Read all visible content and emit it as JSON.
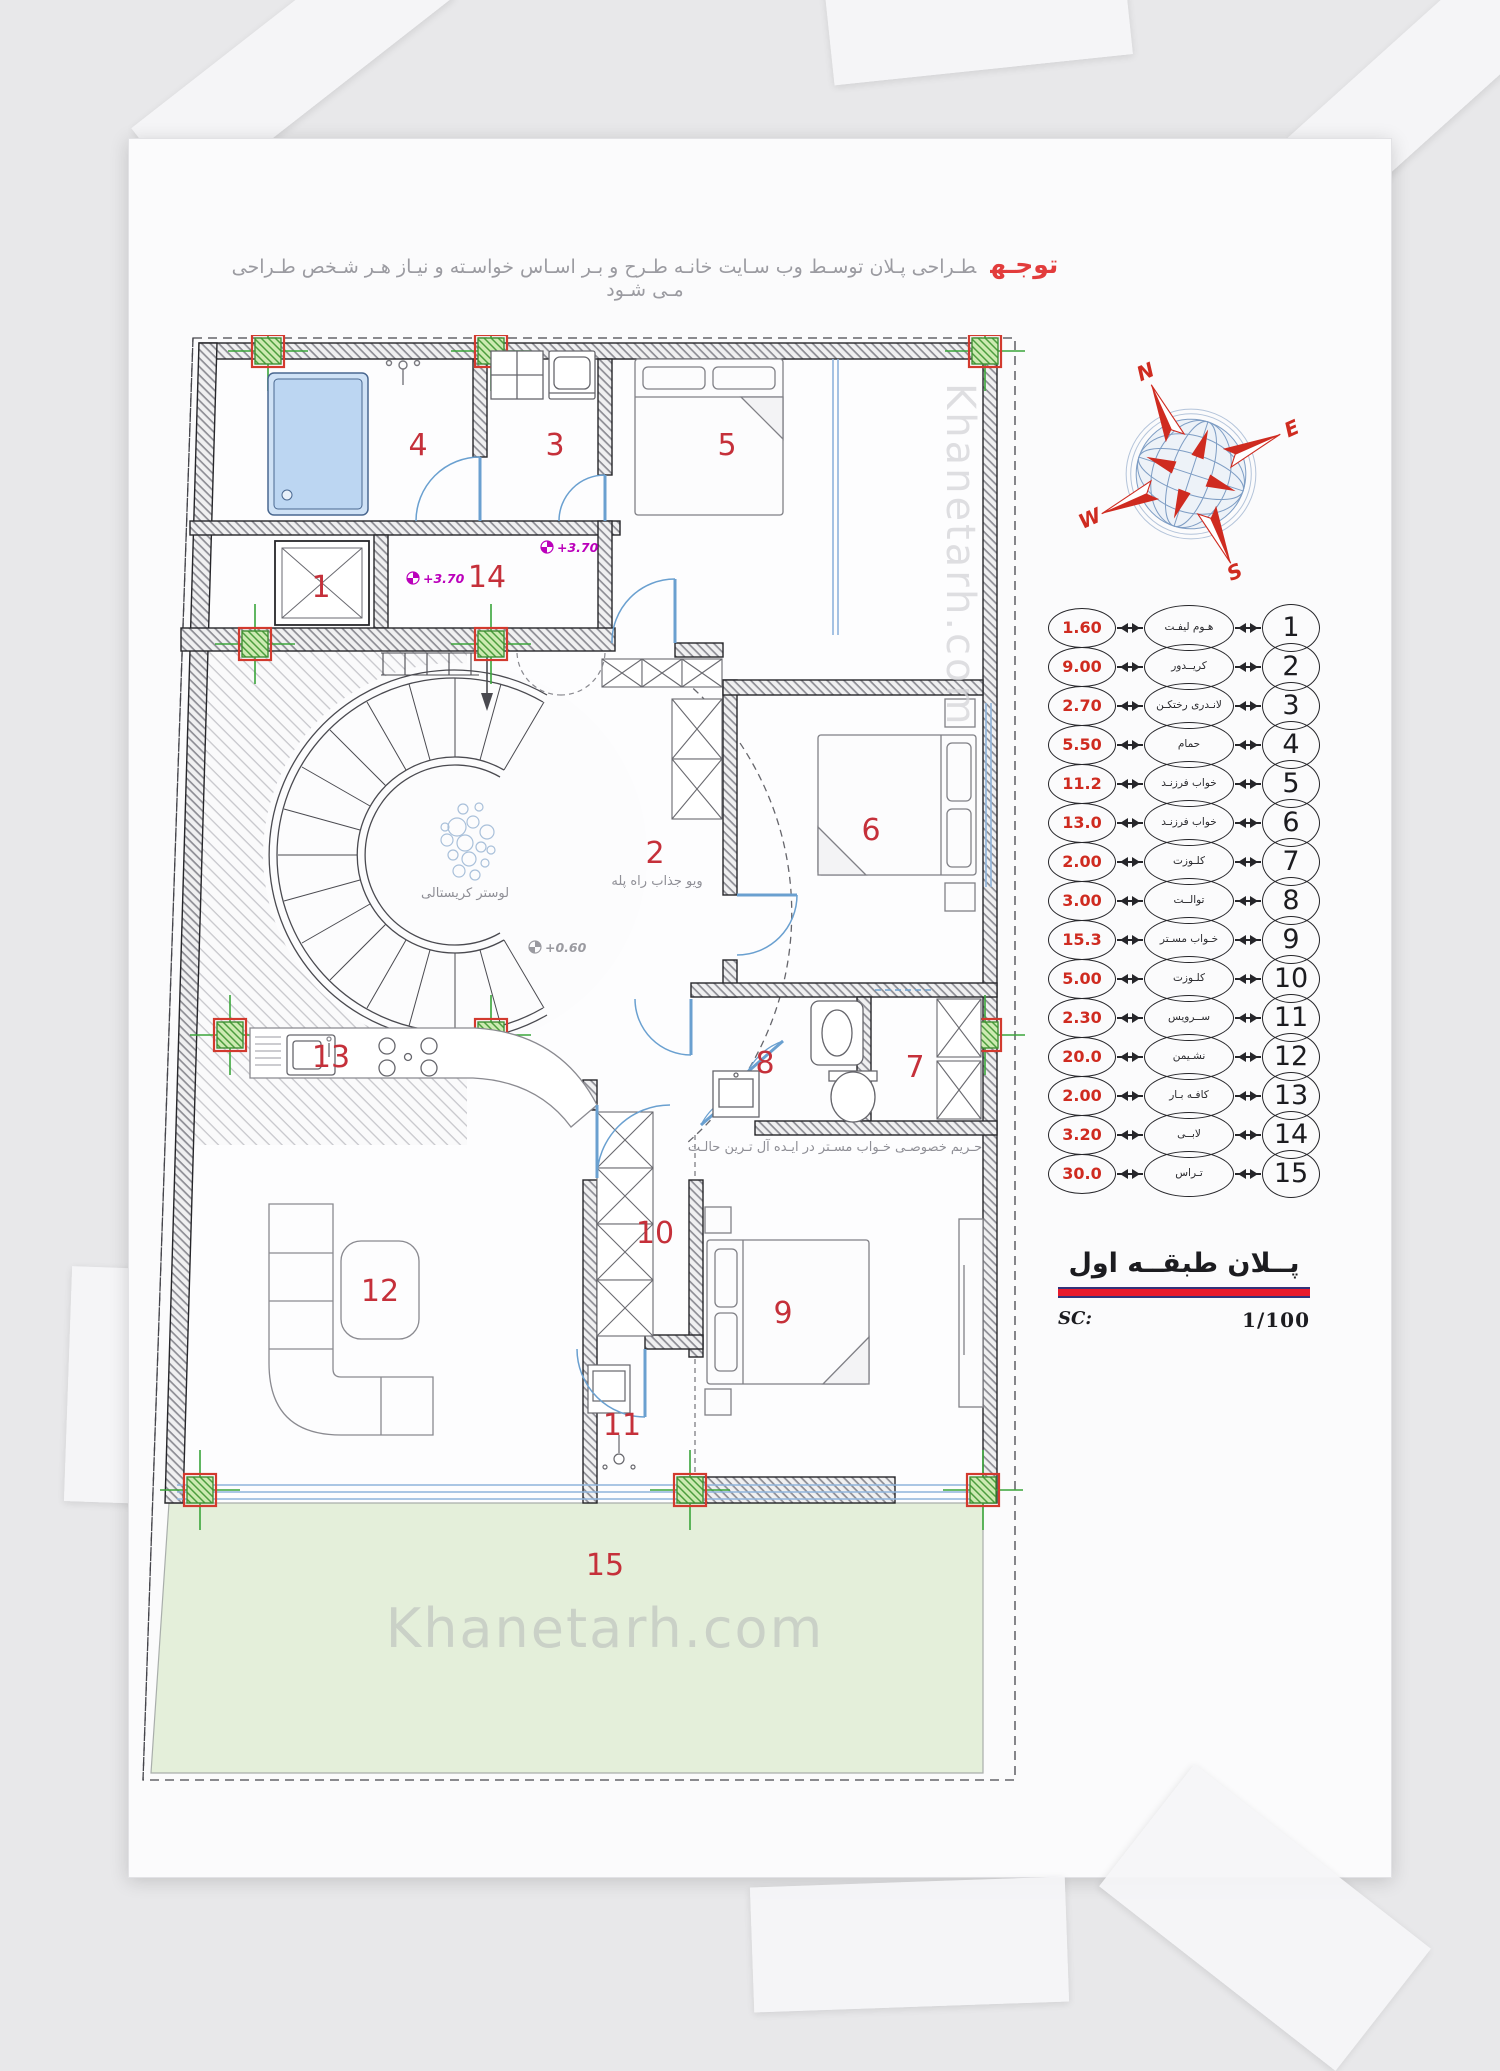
{
  "note": {
    "badge": "توجـه",
    "text": "طـراحی پـلان توسـط وب سـایت خانـه طـرح  و بـر اسـاس خواسـته و نیـاز هـر شـخص طـراحی مـی شـود"
  },
  "watermark": {
    "text": "Khanetarh.com"
  },
  "compass": {
    "n": "N",
    "e": "E",
    "s": "S",
    "w": "W"
  },
  "plan": {
    "room_numbers": [
      "1",
      "2",
      "3",
      "4",
      "5",
      "6",
      "7",
      "8",
      "9",
      "10",
      "11",
      "12",
      "13",
      "14",
      "15"
    ],
    "annotations": {
      "chandelier": "لوستر کریستالی",
      "stair_view": "ویو جذاب راه پله",
      "privacy": "حـریم خصوصـی خـواب مسـتر در ایـده آل تـرین حالـت"
    },
    "levels": {
      "lobby": "+3.70",
      "stair": "+3.70",
      "entry": "+0.60"
    }
  },
  "legend": {
    "rows": [
      {
        "no": "1",
        "name": "هـوم لیفـت",
        "area": "1.60"
      },
      {
        "no": "2",
        "name": "کریــدور",
        "area": "9.00"
      },
      {
        "no": "3",
        "name": "لانـدری رختکـن",
        "area": "2.70"
      },
      {
        "no": "4",
        "name": "حمام",
        "area": "5.50"
      },
      {
        "no": "5",
        "name": "خواب فرزنـد",
        "area": "11.2"
      },
      {
        "no": "6",
        "name": "خواب فرزنـد",
        "area": "13.0"
      },
      {
        "no": "7",
        "name": "کلـوزت",
        "area": "2.00"
      },
      {
        "no": "8",
        "name": "توالــت",
        "area": "3.00"
      },
      {
        "no": "9",
        "name": "خـواب مسـتر",
        "area": "15.3"
      },
      {
        "no": "10",
        "name": "کلـوزت",
        "area": "5.00"
      },
      {
        "no": "11",
        "name": "ســرویس",
        "area": "2.30"
      },
      {
        "no": "12",
        "name": "نشـیمن",
        "area": "20.0"
      },
      {
        "no": "13",
        "name": "کافـه بـار",
        "area": "2.00"
      },
      {
        "no": "14",
        "name": "لابــی",
        "area": "3.20"
      },
      {
        "no": "15",
        "name": "تـراس",
        "area": "30.0"
      }
    ]
  },
  "titleblock": {
    "title": "پــلان طبقــه اول",
    "scale_label": "SC:",
    "scale_value": "1/100"
  },
  "colors": {
    "accent_red": "#c5303a",
    "column_green": "#3f9e3f",
    "window_blue": "#8fb4dc",
    "terrace_green": "#e4efda",
    "level_magenta": "#bb00bb",
    "title_red": "#e8192c"
  }
}
